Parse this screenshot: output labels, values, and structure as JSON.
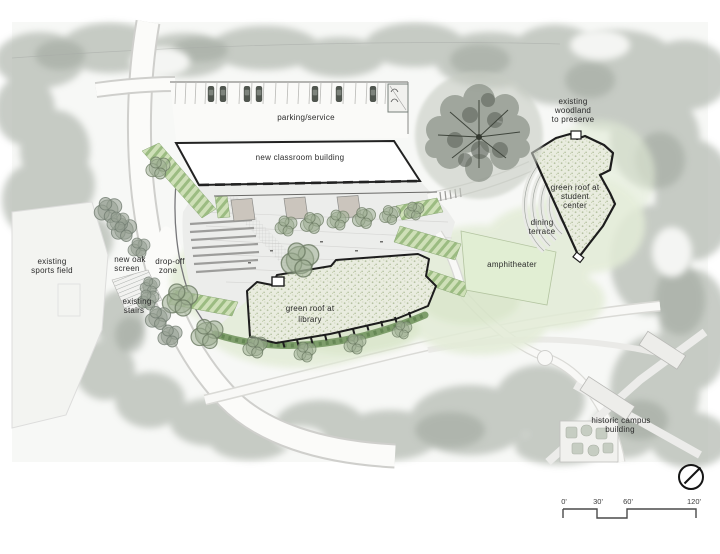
{
  "plan": {
    "labels": {
      "parking": {
        "lines": [
          "parking/service"
        ]
      },
      "classroom": {
        "lines": [
          "new classroom building"
        ]
      },
      "woodland": {
        "lines": [
          "existing",
          "woodland",
          "to preserve"
        ]
      },
      "student_center": {
        "lines": [
          "green roof at",
          "student",
          "center"
        ]
      },
      "dining_terrace": {
        "lines": [
          "dining",
          "terrace"
        ]
      },
      "amphitheater": {
        "lines": [
          "amphitheater"
        ]
      },
      "library": {
        "lines": [
          "green roof at",
          "library"
        ]
      },
      "sports_field": {
        "lines": [
          "existing",
          "sports field"
        ]
      },
      "oak_screen": {
        "lines": [
          "new oak",
          "screen"
        ]
      },
      "drop_off": {
        "lines": [
          "drop-off",
          "zone"
        ]
      },
      "stairs": {
        "lines": [
          "existing",
          "stairs"
        ]
      },
      "historic": {
        "lines": [
          "historic campus",
          "building"
        ]
      }
    },
    "scale_bar": {
      "ticks": [
        "0'",
        "30'",
        "60'",
        "120'"
      ]
    },
    "colors": {
      "roof_fill": "#e9ecdf",
      "lawn": "#e3ecd7",
      "amphitheater": "#e1eed3",
      "hedge": "#7e9e6b",
      "outline": "#1d1d1d",
      "photo_tree": "#b6bcb4"
    }
  }
}
